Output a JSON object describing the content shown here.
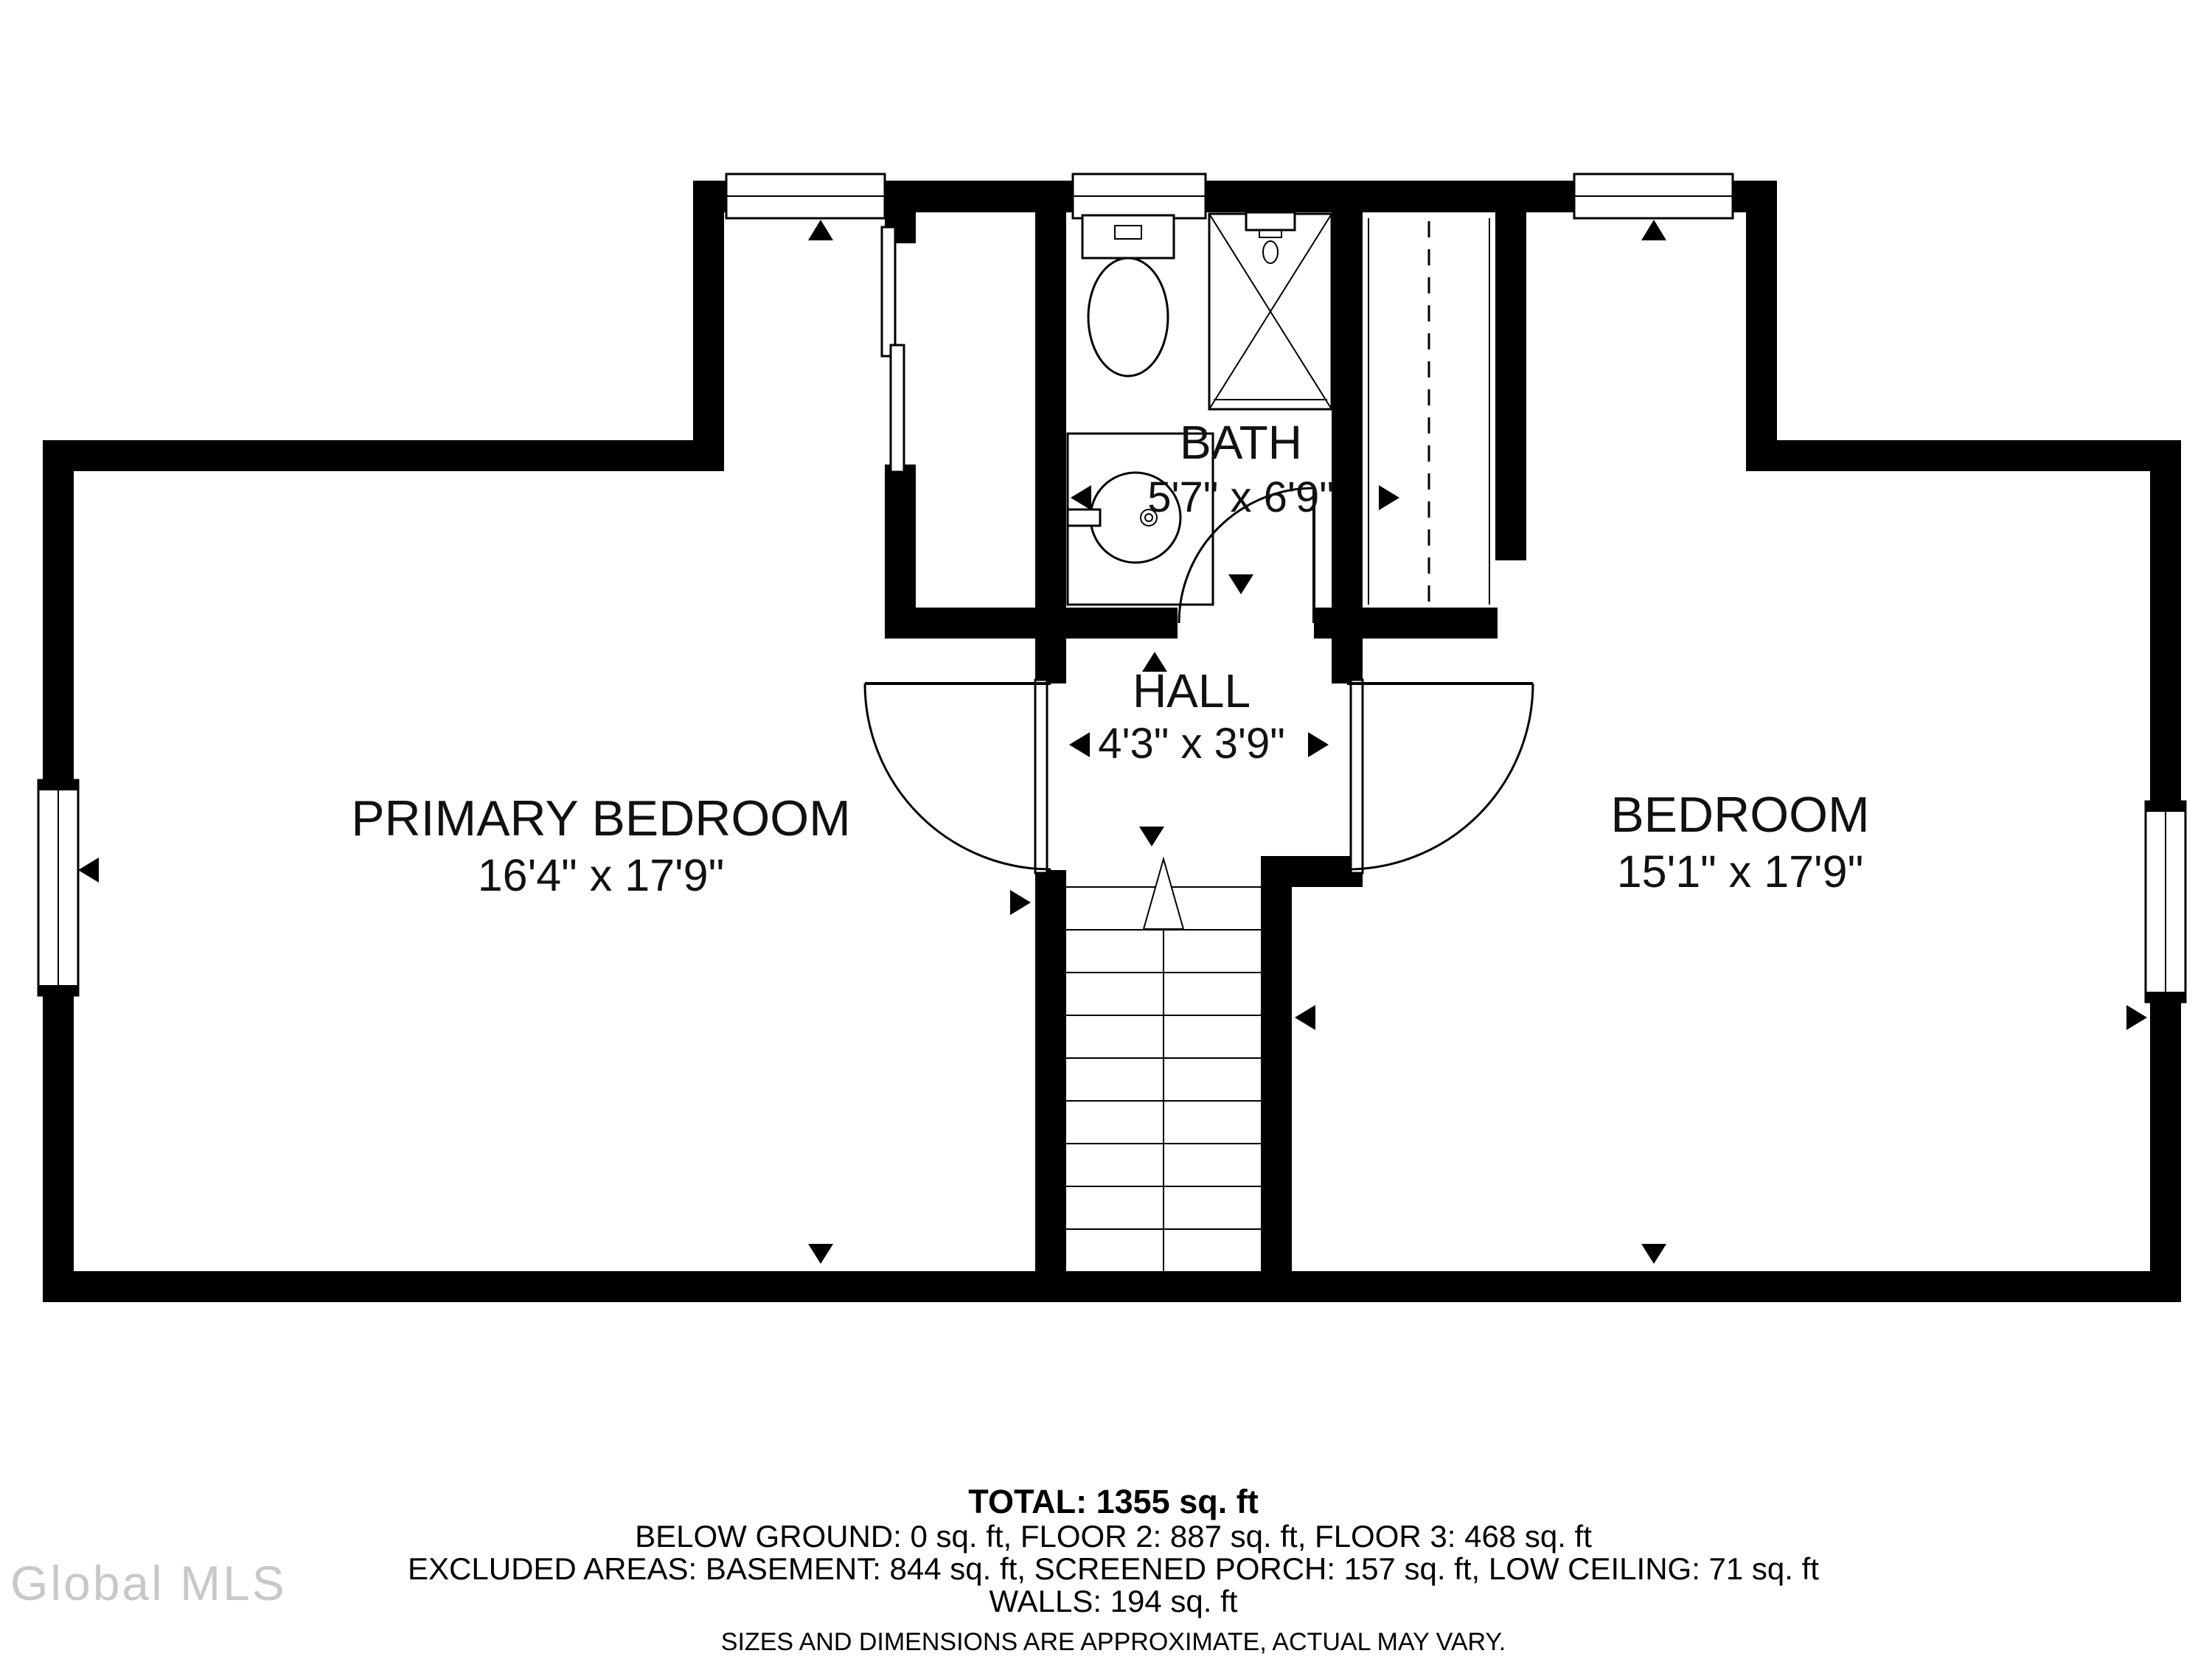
{
  "plan": {
    "rooms": [
      {
        "name": "PRIMARY BEDROOM",
        "dimensions": "16'4\" x 17'9\""
      },
      {
        "name": "BEDROOM",
        "dimensions": "15'1\" x 17'9\""
      },
      {
        "name": "BATH",
        "dimensions": "5'7\" x 6'9\""
      },
      {
        "name": "HALL",
        "dimensions": "4'3\" x 3'9\""
      }
    ],
    "fixtures": [
      "toilet",
      "shower",
      "sink-vanity",
      "closet-rod",
      "stairs-up"
    ],
    "colors": {
      "walls": "#000000",
      "background": "#ffffff",
      "watermark": "#c8c8c8"
    }
  },
  "footer": {
    "total_line": "TOTAL: 1355 sq. ft",
    "area_line": "BELOW GROUND: 0 sq. ft, FLOOR 2: 887 sq. ft, FLOOR 3: 468 sq. ft",
    "excluded_line": "EXCLUDED AREAS: BASEMENT: 844 sq. ft, SCREENED PORCH: 157 sq. ft, LOW CEILING: 71 sq. ft",
    "walls_line": "WALLS: 194 sq. ft",
    "disclaimer": "SIZES AND DIMENSIONS ARE APPROXIMATE, ACTUAL MAY VARY."
  },
  "watermark": {
    "text": "Global MLS"
  }
}
